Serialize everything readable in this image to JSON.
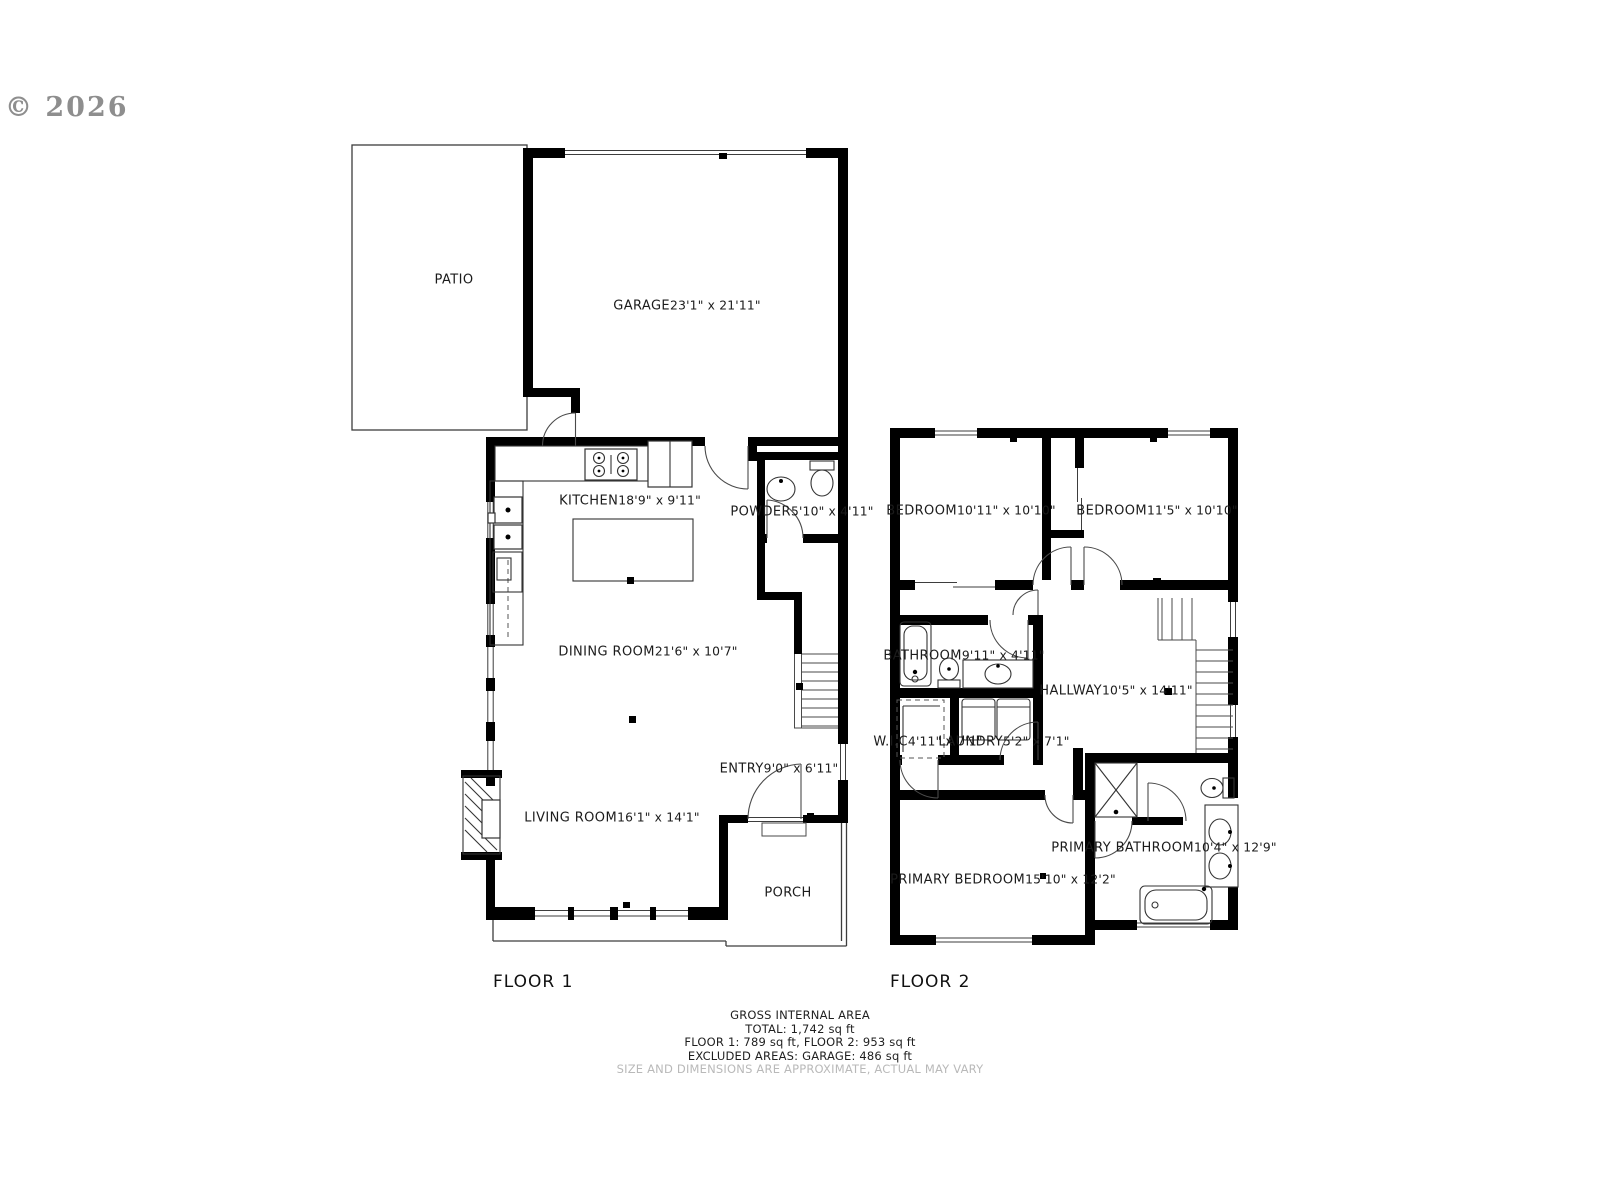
{
  "copyright": "© 2026",
  "floor1_label": "FLOOR 1",
  "floor2_label": "FLOOR 2",
  "rooms": {
    "patio": {
      "name": "PATIO",
      "dims": ""
    },
    "garage": {
      "name": "GARAGE",
      "dims": "23'1\" x 21'11\""
    },
    "kitchen": {
      "name": "KITCHEN",
      "dims": "18'9\" x 9'11\""
    },
    "powder": {
      "name": "POWDER",
      "dims": "5'10\" x 4'11\""
    },
    "dining": {
      "name": "DINING ROOM",
      "dims": "21'6\" x 10'7\""
    },
    "entry": {
      "name": "ENTRY",
      "dims": "9'0\" x 6'11\""
    },
    "living": {
      "name": "LIVING ROOM",
      "dims": "16'1\" x 14'1\""
    },
    "porch": {
      "name": "PORCH",
      "dims": ""
    },
    "bedroom1": {
      "name": "BEDROOM",
      "dims": "10'11\" x 10'10\""
    },
    "bedroom2": {
      "name": "BEDROOM",
      "dims": "11'5\" x 10'10\""
    },
    "bathroom": {
      "name": "BATHROOM",
      "dims": "9'11\" x 4'11\""
    },
    "hallway": {
      "name": "HALLWAY",
      "dims": "10'5\" x 14'11\""
    },
    "wic": {
      "name": "W.I.C",
      "dims": "4'11\" x 7'1\""
    },
    "laundry": {
      "name": "LAUNDRY",
      "dims": "5'2\" x 7'1\""
    },
    "primary_bedroom": {
      "name": "PRIMARY BEDROOM",
      "dims": "15'10\" x 12'2\""
    },
    "primary_bathroom": {
      "name": "PRIMARY BATHROOM",
      "dims": "10'4\" x 12'9\""
    }
  },
  "footer": {
    "line1": "GROSS INTERNAL AREA",
    "line2": "TOTAL: 1,742 sq ft",
    "line3": "FLOOR 1: 789 sq ft, FLOOR 2: 953 sq ft",
    "line4": "EXCLUDED AREAS: GARAGE: 486 sq ft",
    "line5": "SIZE AND DIMENSIONS ARE APPROXIMATE, ACTUAL MAY VARY"
  }
}
